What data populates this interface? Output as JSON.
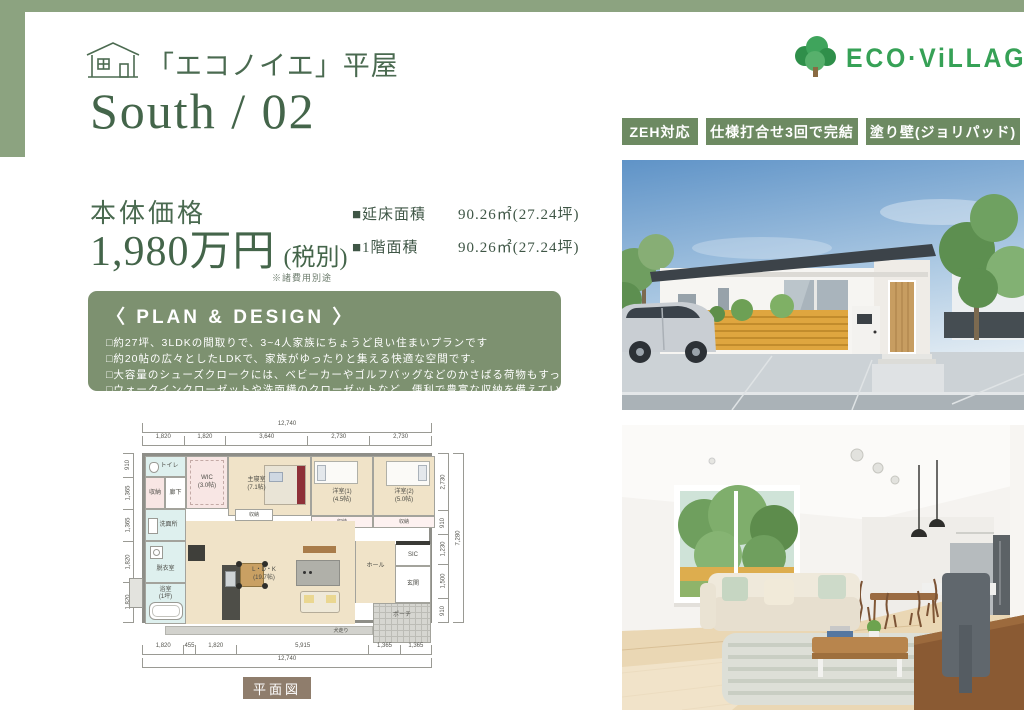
{
  "colors": {
    "accent_green": "#8ca380",
    "badge_green": "#6d8a62",
    "plan_box_green": "#7d9170",
    "heading_green": "#4a6a50",
    "logo_green": "#36a156",
    "caption_brown": "#8f7d6c"
  },
  "header": {
    "series_title": "「エコノイエ」平屋",
    "model_name": "South / 02",
    "house_icon": "house-icon"
  },
  "logo": {
    "icon": "tree-icon",
    "text": "ECO·ViLLAGE"
  },
  "badges": [
    "ZEH対応",
    "仕様打合せ3回で完結",
    "塗り壁(ジョリパッド)"
  ],
  "price": {
    "label": "本体価格",
    "amount": "1,980万円",
    "tax_note": "(税別)",
    "disclaimer": "※諸費用別途"
  },
  "areas": [
    {
      "label": "■延床面積",
      "value": "90.26㎡(27.24坪)"
    },
    {
      "label": "■1階面積",
      "value": "90.26㎡(27.24坪)"
    }
  ],
  "plan_design": {
    "title": "〈 PLAN & DESIGN 〉",
    "items": [
      "□約27坪、3LDKの間取りで、3~4人家族にちょうど良い住まいプランです",
      "□約20帖の広々としたLDKで、家族がゆったりと集える快適な空間です。",
      "□大容量のシューズクロークには、ベビーカーやゴルフバッグなどのかさばる荷物もすっきり収納できます。",
      "□ウォークインクローゼットや洗面横のクローゼットなど、便利で豊富な収納を備えています。"
    ]
  },
  "floorplan": {
    "caption": "平面図",
    "dims": {
      "top_total": "12,740",
      "top": [
        "1,820",
        "1,820",
        "3,640",
        "2,730",
        "2,730"
      ],
      "bottom": [
        "1,820",
        "455",
        "1,820",
        "5,915",
        "1,365",
        "1,365"
      ],
      "bottom_total": "12,740",
      "left": [
        "910",
        "1,365",
        "1,365",
        "1,820",
        "1,820"
      ],
      "right": [
        "2,730",
        "910",
        "1,230",
        "1,500",
        "910"
      ],
      "right_total": "7,280"
    },
    "rooms": {
      "toilet": "トイレ",
      "storage": "収納",
      "hallway": "廊下",
      "wic": "WIC",
      "wic_size": "(3.0帖)",
      "master": "主寝室",
      "master_size": "(7.1帖)",
      "bedroom1": "洋室(1)",
      "bedroom1_size": "(4.5帖)",
      "bedroom2": "洋室(2)",
      "bedroom2_size": "(5.0帖)",
      "closet": "収納",
      "washroom": "洗面所",
      "dressing": "脱衣室",
      "bath": "浴室",
      "bath_size": "(1坪)",
      "ldk": "L・D・K",
      "ldk_size": "(19.7帖)",
      "hall": "ホール",
      "sic": "SIC",
      "entrance": "玄関",
      "porch": "ポーチ",
      "apron": "犬走り"
    }
  }
}
